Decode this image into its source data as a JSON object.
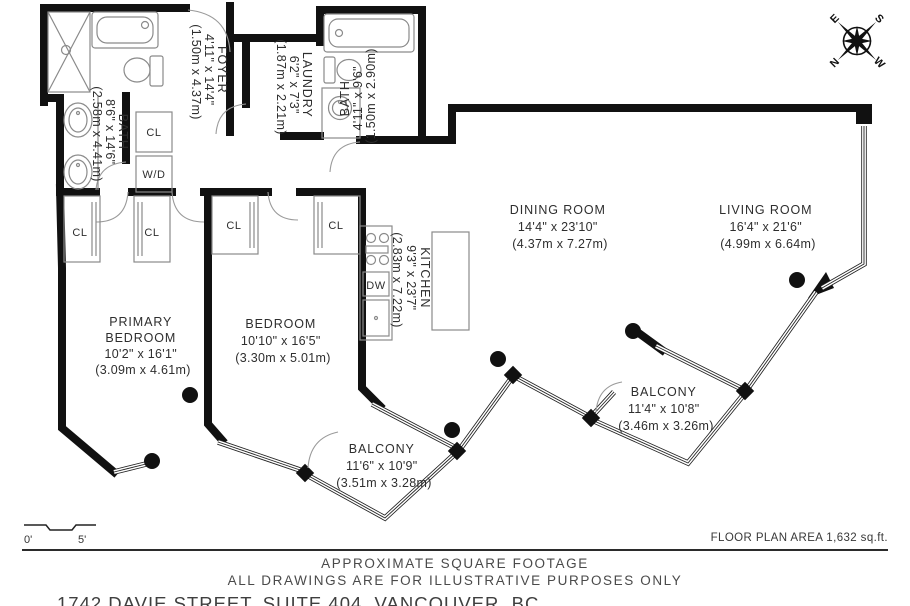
{
  "rooms": {
    "primary_bedroom": {
      "lines": [
        "PRIMARY",
        "BEDROOM",
        "10'2\" x 16'1\"",
        "(3.09m x 4.61m)"
      ]
    },
    "bedroom": {
      "lines": [
        "BEDROOM",
        "10'10\" x 16'5\"",
        "(3.30m x 5.01m)"
      ]
    },
    "dining_room": {
      "lines": [
        "DINING ROOM",
        "14'4\" x 23'10\"",
        "(4.37m x 7.27m)"
      ]
    },
    "living_room": {
      "lines": [
        "LIVING ROOM",
        "16'4\" x 21'6\"",
        "(4.99m x 6.64m)"
      ]
    },
    "kitchen": {
      "lines": [
        "KITCHEN",
        "9'3\" x 23'7\"",
        "(2.83m x 7.22m)"
      ]
    },
    "foyer": {
      "lines": [
        "FOYER",
        "4'11\" x 14'4\"",
        "(1.50m x 4.37m)"
      ]
    },
    "laundry": {
      "lines": [
        "LAUNDRY",
        "6'2\" x 7'3\"",
        "(1.87m x 2.21m)"
      ]
    },
    "bath_main": {
      "lines": [
        "BATH",
        "8'6\" x 14'6\"",
        "(2.58m x 4.41m)"
      ]
    },
    "bath_second": {
      "lines": [
        "BATH",
        "4'11\" x 9'6\"",
        "(1.50m x 2.90m)"
      ]
    },
    "balcony_west": {
      "lines": [
        "BALCONY",
        "11'6\" x 10'9\"",
        "(3.51m x 3.28m)"
      ]
    },
    "balcony_east": {
      "lines": [
        "BALCONY",
        "11'4\" x 10'8\"",
        "(3.46m x 3.26m)"
      ]
    }
  },
  "labels": {
    "closet": "CL",
    "washer_dryer": "W/D",
    "dishwasher": "DW"
  },
  "compass": {
    "n": "N",
    "e": "E",
    "s": "S",
    "w": "W"
  },
  "scale_bar": {
    "start": "0'",
    "end": "5'"
  },
  "footer": {
    "area": "FLOOR PLAN AREA 1,632 sq.ft.",
    "line1": "APPROXIMATE SQUARE FOOTAGE",
    "line2": "ALL DRAWINGS ARE FOR ILLUSTRATIVE PURPOSES ONLY",
    "address": "1742 DAVIE STREET, SUITE 404, VANCOUVER, BC"
  },
  "colors": {
    "wall": "#111111",
    "fixture": "#8a8a8a",
    "accent_text": "#2e2e2e"
  }
}
